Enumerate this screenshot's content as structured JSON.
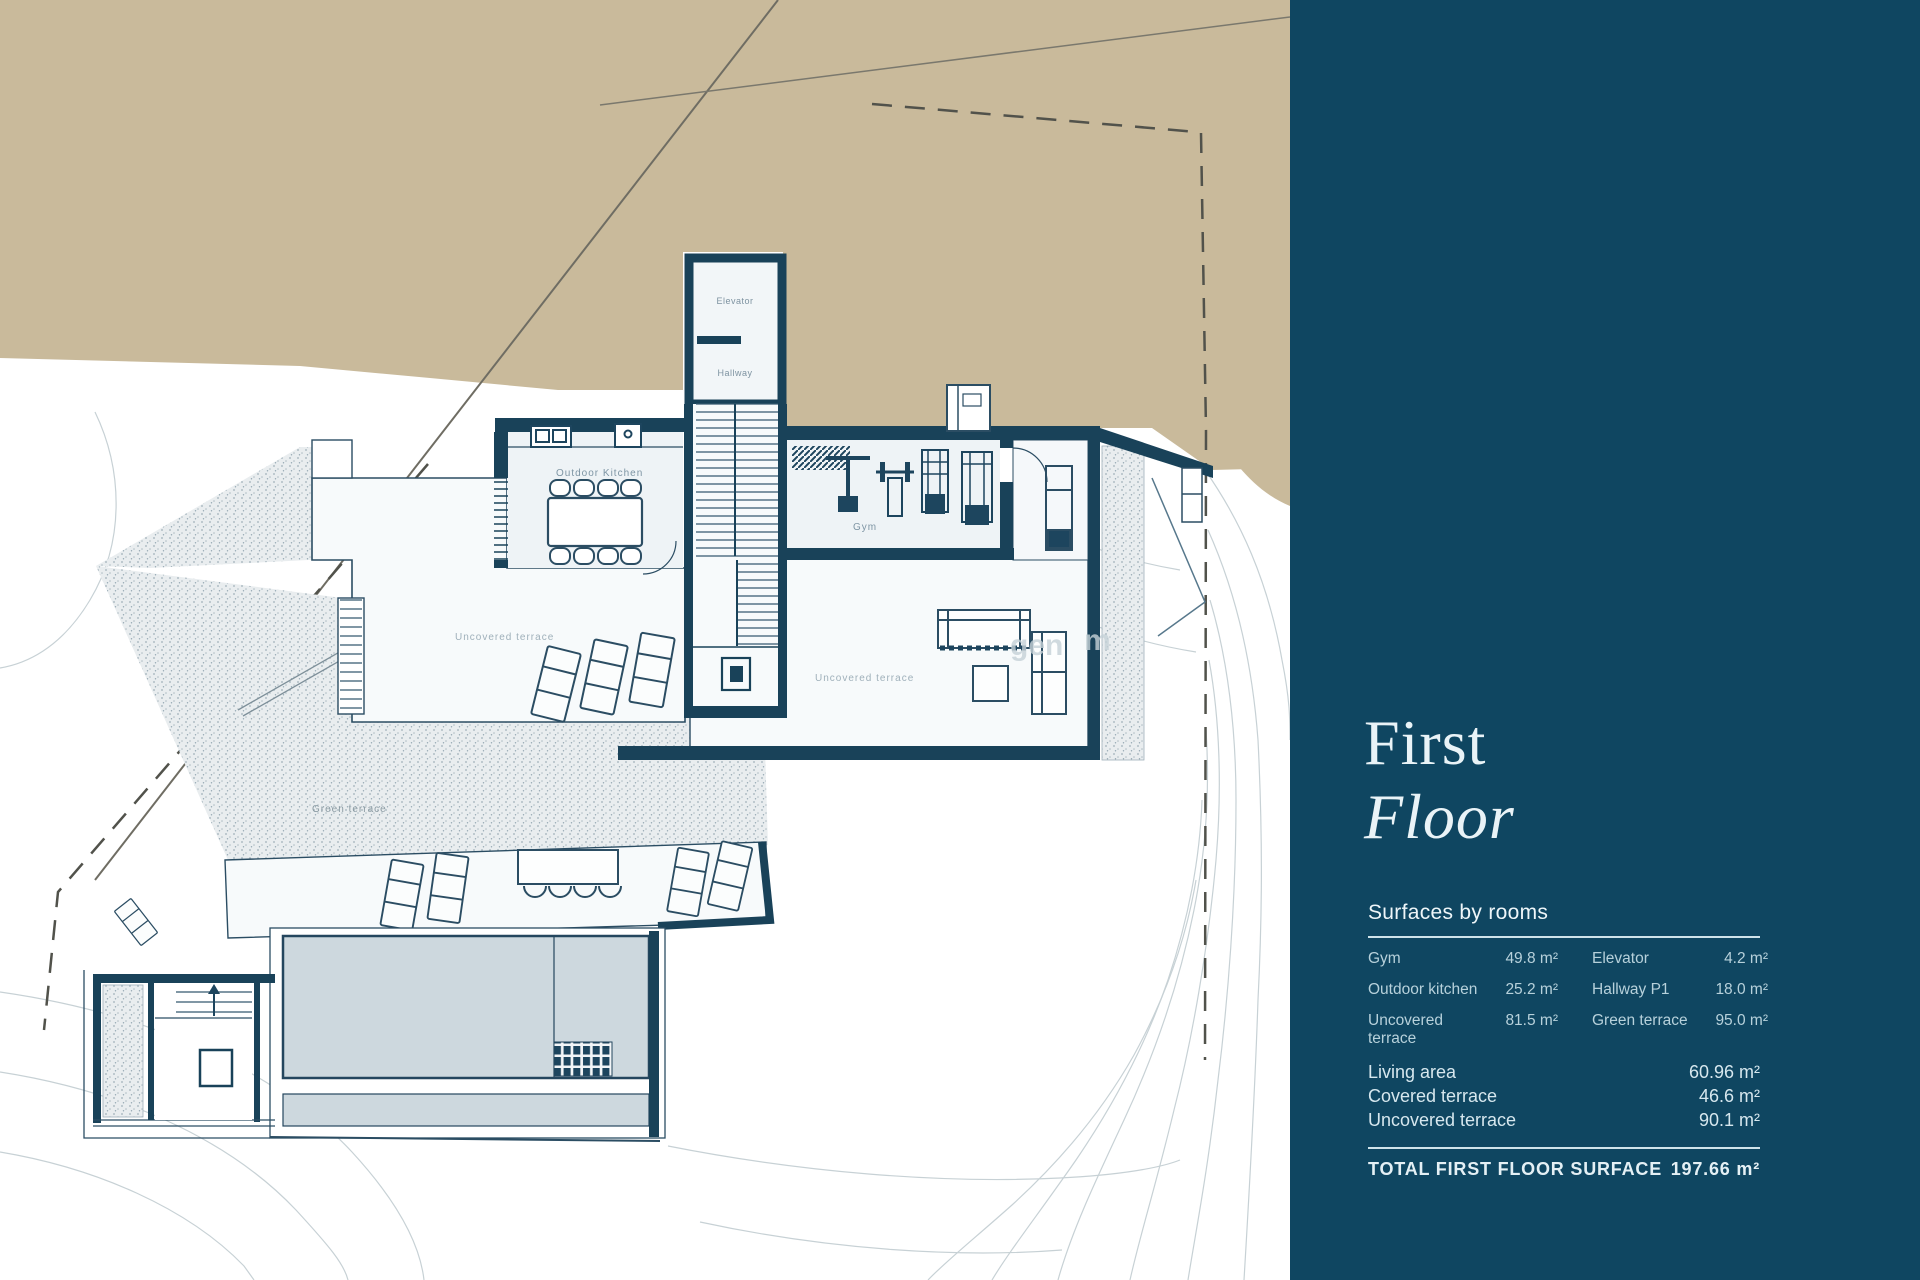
{
  "sidebar": {
    "title_line1": "First",
    "title_line2": "Floor",
    "section_title": "Surfaces by rooms",
    "rooms": [
      {
        "name": "Gym",
        "area": "49.8 m²"
      },
      {
        "name": "Outdoor kitchen",
        "area": "25.2 m²"
      },
      {
        "name": "Uncovered terrace",
        "area": "81.5 m²"
      },
      {
        "name": "Elevator",
        "area": "4.2 m²"
      },
      {
        "name": "Hallway P1",
        "area": "18.0 m²"
      },
      {
        "name": "Green terrace",
        "area": "95.0 m²"
      }
    ],
    "summary": [
      {
        "name": "Living area",
        "area": "60.96 m²"
      },
      {
        "name": "Covered terrace",
        "area": "46.6 m²"
      },
      {
        "name": "Uncovered terrace",
        "area": "90.1 m²"
      }
    ],
    "total_label": "TOTAL FIRST FLOOR SURFACE",
    "total_value": "197.66 m²",
    "colors": {
      "background": "#0f4661",
      "heading": "#e9f3f7",
      "muted": "#b7d1db",
      "rule": "#cfe3ea"
    }
  },
  "plan": {
    "labels": {
      "elevator": "Elevator",
      "hallway": "Hallway",
      "outdoor_kitchen": "Outdoor  Kitchen",
      "gym": "Gym",
      "uncovered_terrace_left": "Uncovered terrace",
      "uncovered_terrace_right": "Uncovered terrace",
      "green_terrace": "Green terrace"
    },
    "watermark_fragments": {
      "f1": "gen",
      "f2": "m"
    },
    "colors": {
      "land": "#c9ba9b",
      "walls": "#194259",
      "room_fill": "#eef3f6",
      "terrace_fill": "#f7fafb",
      "water": "#cdd8de",
      "contour": "#c7d1d5"
    }
  }
}
